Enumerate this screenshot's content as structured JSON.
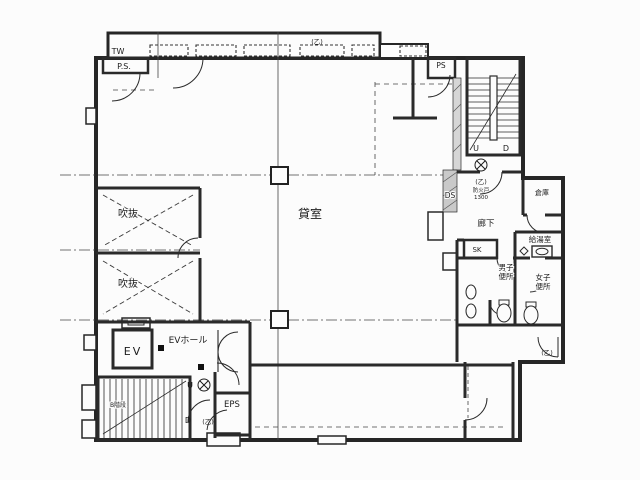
{
  "colors": {
    "line": "#262626",
    "paper": "#fcfcfc",
    "wall_fill": "#cfcfcf"
  },
  "labels": {
    "top_left": {
      "tw": "TW",
      "ps": "P.S."
    },
    "top_center": {
      "otsu": "(乙)"
    },
    "northeast": {
      "ps": "PS",
      "up": "U",
      "down": "D",
      "otsu": "(乙)",
      "fire_note_1": "防火戸",
      "fire_note_2": "1300",
      "ds": "DS"
    },
    "east": {
      "storage": "倉庫",
      "corridor": "廊下",
      "kitchenette": "給湯室",
      "sk": "SK",
      "mens_1": "男子",
      "mens_2": "便所",
      "womens_1": "女子",
      "womens_2": "便所",
      "otsu": "(乙)"
    },
    "west": {
      "void_upper": "吹抜",
      "void_lower": "吹抜"
    },
    "center": {
      "rental": "貸室"
    },
    "southwest": {
      "ev": "EV",
      "ev_hall": "EVホール",
      "eps": "EPS",
      "up": "U",
      "down": "D",
      "otsu": "(乙)",
      "stair": "B階段"
    }
  }
}
